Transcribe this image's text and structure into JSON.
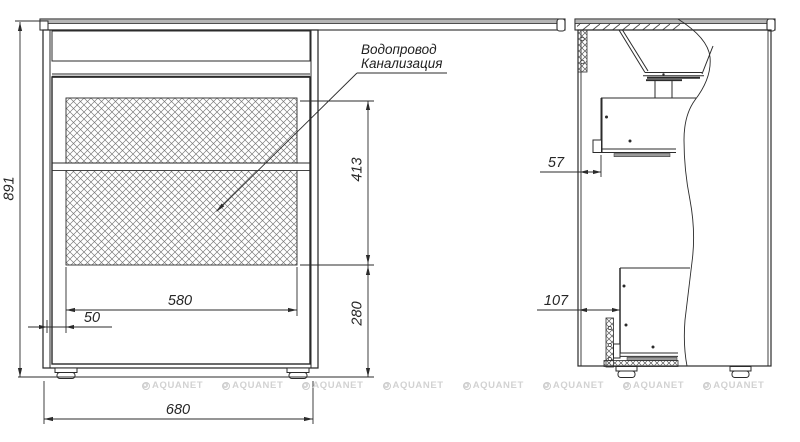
{
  "drawing": {
    "title_hint": "vanity cabinet technical drawing",
    "annotation": {
      "line1": "Водопровод",
      "line2": "Канализация"
    },
    "front_view": {
      "dim_height": "891",
      "dim_overall_width": "680",
      "dim_panel_width": "580",
      "dim_side_offset": "50",
      "dim_upper_section": "413",
      "dim_lower_section": "280"
    },
    "side_view": {
      "dim_top_gap": "57",
      "dim_bottom_gap": "107"
    },
    "watermark": {
      "text": "AQUANET"
    },
    "colors": {
      "line": "#2b2b2b",
      "hatch": "#787878",
      "countertop_fill": "#b5b5b5",
      "watermark": "#d2d2d2"
    }
  }
}
